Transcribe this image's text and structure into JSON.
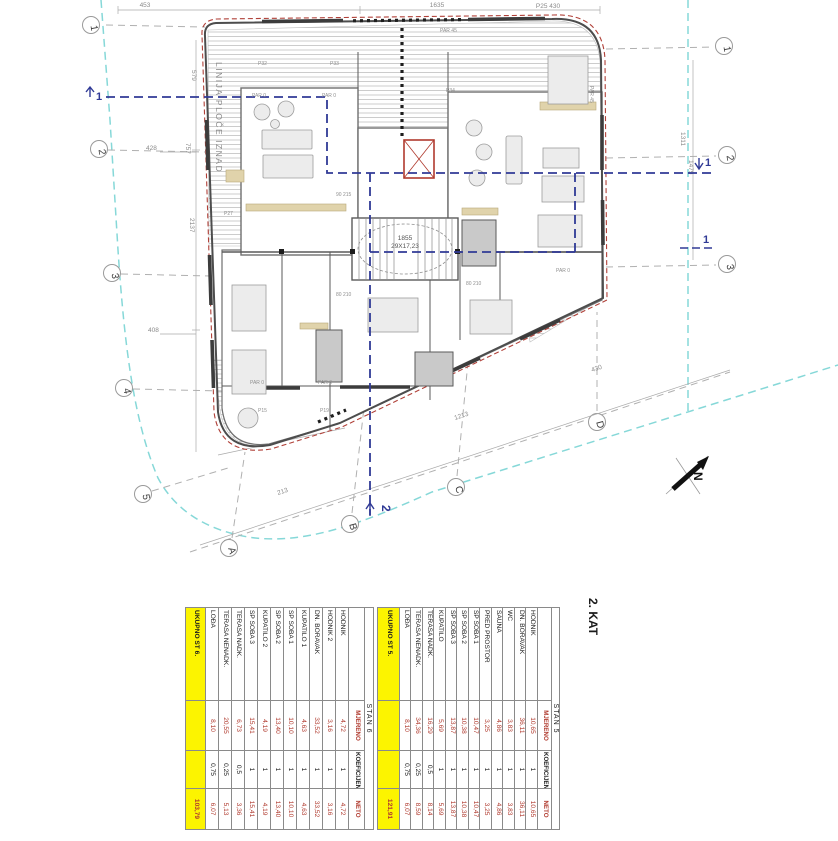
{
  "floor_title": "2. KAT",
  "plan": {
    "grid": {
      "left": [
        "1",
        "2",
        "3",
        "4",
        "5"
      ],
      "right": [
        "1",
        "2",
        "3"
      ],
      "bottom": [
        "A",
        "B",
        "C",
        "D"
      ]
    },
    "sections": {
      "s1": "1",
      "s2": "2"
    },
    "labels": {
      "slab_line": "LINIJA PLOČE IZNAD",
      "stair_dim": "1855",
      "stair_count": "29X17,23",
      "par0": "PAR 0",
      "par45": "PAR 45",
      "p32": "P32",
      "p33": "P33",
      "p34": "P34",
      "p27": "P27",
      "p15": "P15",
      "p19": "P19",
      "door_80": "80 210",
      "door_90": "90 215",
      "north": "N"
    },
    "dims": {
      "top_left": "453",
      "top_mid": "1635",
      "top_right": "P25  430",
      "left_579": "579",
      "left_2137": "2137",
      "left_757": "757",
      "left_428": "428",
      "left_408": "408",
      "right_1311": "1311",
      "right_1479": "1479",
      "diag_213": "213",
      "diag_1213": "1213",
      "bottom_430": "430"
    }
  },
  "tables": [
    {
      "title": "STAN 6",
      "columns": [
        "",
        "MJERENO",
        "KOEFICIJENT",
        "NETO"
      ],
      "rows": [
        [
          "HODNIK",
          "4,72",
          "1",
          "4,72"
        ],
        [
          "HODNIK 2",
          "3,16",
          "1",
          "3,16"
        ],
        [
          "DN. BORAVAK",
          "33,52",
          "1",
          "33,52"
        ],
        [
          "KUPATILO 1",
          "4,63",
          "1",
          "4,63"
        ],
        [
          "SP SOBA 1",
          "10,10",
          "1",
          "10,10"
        ],
        [
          "SP SOBA 2",
          "13,40",
          "1",
          "13,40"
        ],
        [
          "KUPATILO 2",
          "4,19",
          "1",
          "4,19"
        ],
        [
          "SP SOBA 3",
          "15,41",
          "1",
          "15,41"
        ],
        [
          "TERASA NADK.",
          "6,73",
          "0,5",
          "3,36"
        ],
        [
          "TERASA NENADK.",
          "20,55",
          "0,25",
          "5,13"
        ],
        [
          "LOĐA",
          "8,10",
          "0,75",
          "6,07"
        ]
      ],
      "total_label": "UKUPNO ST 6.",
      "total_value": "103,79"
    },
    {
      "title": "STAN 5",
      "columns": [
        "",
        "MJERENO",
        "KOEFICIJENT",
        "NETO"
      ],
      "rows": [
        [
          "HODNIK",
          "10,65",
          "1",
          "10,65"
        ],
        [
          "DN. BORAVAK",
          "36,11",
          "1",
          "36,11"
        ],
        [
          "WC",
          "3,83",
          "1",
          "3,83"
        ],
        [
          "SAUNA",
          "4,86",
          "1",
          "4,86"
        ],
        [
          "PRED PROSTOR",
          "3,25",
          "1",
          "3,25"
        ],
        [
          "SP SOBA 1",
          "10,47",
          "1",
          "10,47"
        ],
        [
          "SP SOBA 2",
          "10,38",
          "1",
          "10,38"
        ],
        [
          "SP SOBA 3",
          "13,87",
          "1",
          "13,87"
        ],
        [
          "KUPATILO",
          "5,69",
          "1",
          "5,69"
        ],
        [
          "TERASA NADK.",
          "16,29",
          "0,5",
          "8,14"
        ],
        [
          "TERASA NENADK.",
          "34,36",
          "0,25",
          "8,59"
        ],
        [
          "LOĐA",
          "8,10",
          "0,75",
          "6,07"
        ]
      ],
      "total_label": "UKUPNO ST 5.",
      "total_value": "121,91"
    }
  ],
  "colors": {
    "red_text": "#b03a2e",
    "yellow": "#fcf400",
    "cyan": "#86d8d8",
    "navy": "#303a96",
    "outline_red": "#b04038",
    "grid_gray": "#b0b0b0"
  }
}
